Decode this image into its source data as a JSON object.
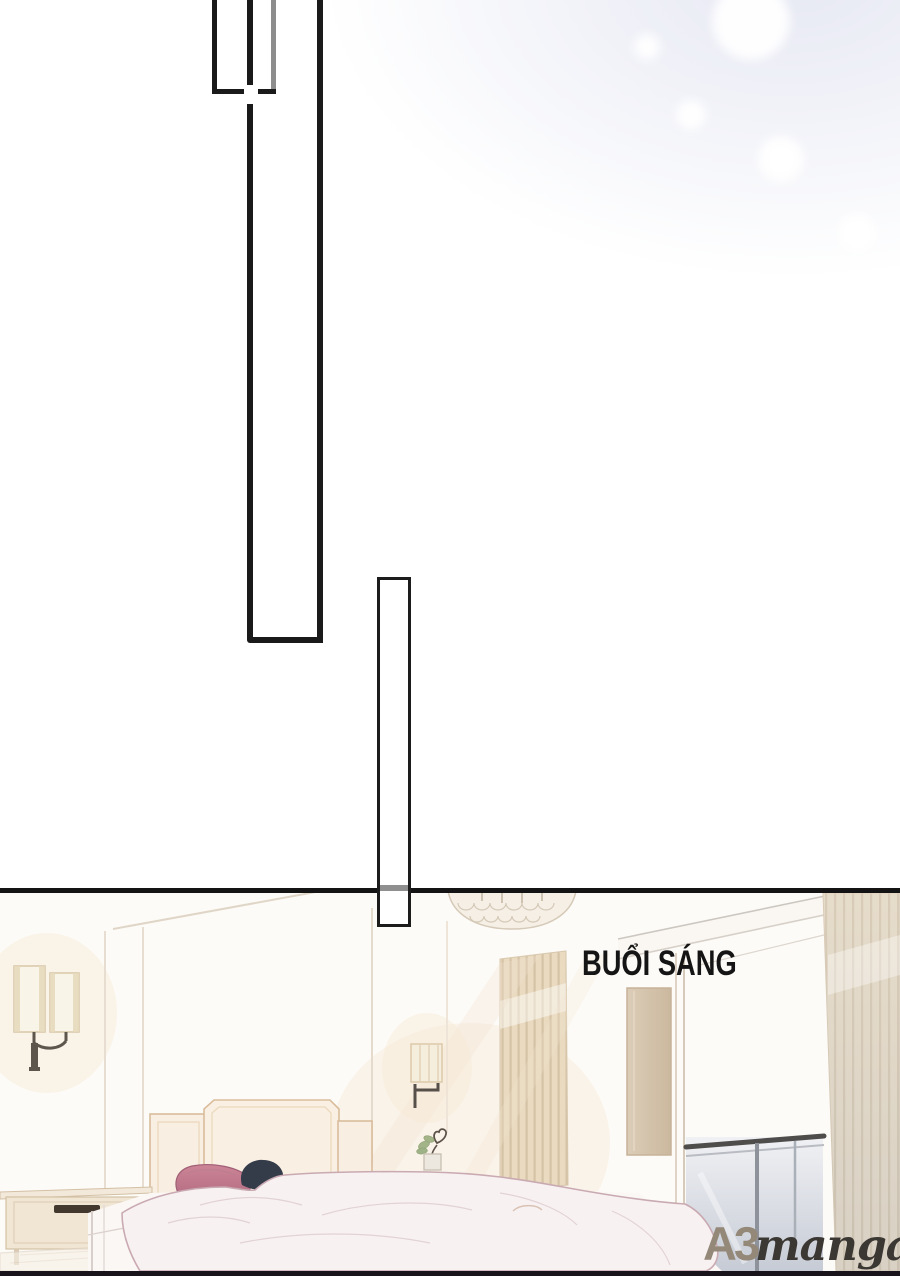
{
  "page": {
    "kind": "manga page",
    "divider_color": "#141414",
    "bottom_strip_color": "#19131b",
    "sky_tint": "#e6e8f3",
    "background": "#ffffff"
  },
  "panels": {
    "transition_rect_count": 3,
    "border_color": "#1a1a1a",
    "muted_border_color": "#8d8d8d"
  },
  "caption": {
    "text": "BUỔI SÁNG",
    "color": "#151515"
  },
  "watermark": {
    "logo": "A3",
    "name": "manga",
    "logo_color": "#948879",
    "name_color": "#3b3733"
  },
  "scene": {
    "description": "pale morning bedroom: chandelier, wall sconces, curtains, glass door with balcony railing, bed with sleeping person",
    "elements": [
      "chandelier",
      "wall-sconce-left",
      "wall-sconce-right",
      "curtain-left",
      "curtain-right",
      "mirror-panel",
      "glass-door",
      "balcony-railing",
      "headboard",
      "pillow",
      "sleeping-person-hair",
      "blanket",
      "nightstand",
      "drawer-handle",
      "plant-vase",
      "rug",
      "light-rays"
    ],
    "colors": {
      "wall": "#fdfbf7",
      "curtain": "#e9dac0",
      "pillow": "#c47e92",
      "hair": "#343b49",
      "blanket": "#f8f1f2",
      "headboard": "#f9efe2",
      "wood": "#f1e5d3",
      "railing": "#4f4d4b",
      "glass": "#dfe3e9"
    }
  }
}
